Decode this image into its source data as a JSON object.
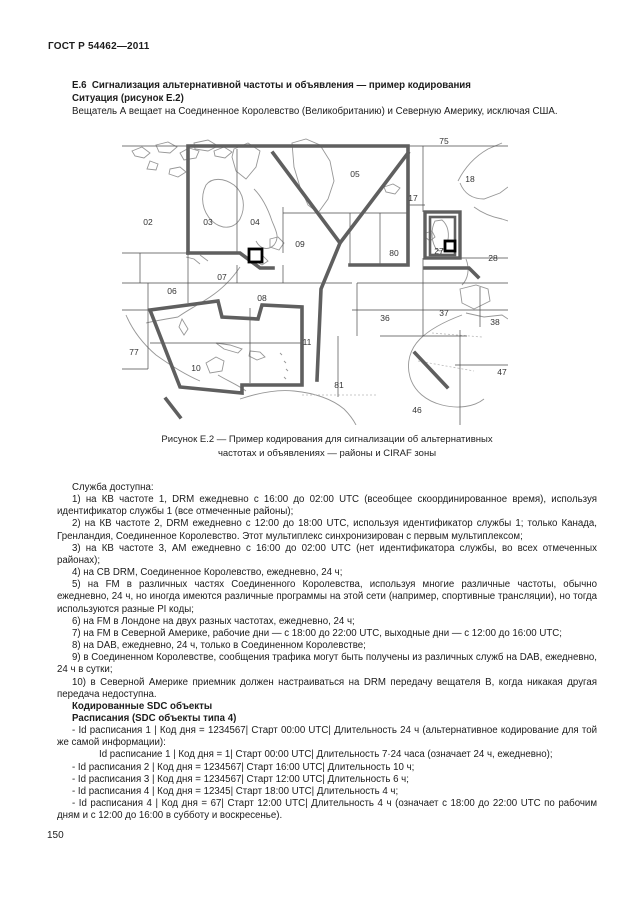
{
  "page": {
    "standard": "ГОСТ Р 54462—2011",
    "number": "150"
  },
  "section": {
    "heading": "Е.6  Сигнализация альтернативной частоты и объявления — пример кодирования",
    "situation": "Ситуация (рисунок Е.2)",
    "intro": "Вещатель А вещает на Соединенное Королевство (Великобританию) и Северную Америку, исключая США."
  },
  "figure": {
    "caption_line1": "Рисунок Е.2 — Пример кодирования для сигнализации об альтернативных",
    "caption_line2": "частотах и объявлениях — районы и CIRAF зоны",
    "zones": [
      {
        "label": "75",
        "x": 322,
        "y": 7
      },
      {
        "label": "05",
        "x": 233,
        "y": 40
      },
      {
        "label": "18",
        "x": 348,
        "y": 45
      },
      {
        "label": "17",
        "x": 291,
        "y": 64
      },
      {
        "label": "02",
        "x": 26,
        "y": 88
      },
      {
        "label": "03",
        "x": 86,
        "y": 88
      },
      {
        "label": "04",
        "x": 133,
        "y": 88
      },
      {
        "label": "09",
        "x": 178,
        "y": 110
      },
      {
        "label": "80",
        "x": 272,
        "y": 119
      },
      {
        "label": "27",
        "x": 317,
        "y": 117
      },
      {
        "label": "28",
        "x": 371,
        "y": 124
      },
      {
        "label": "07",
        "x": 100,
        "y": 143
      },
      {
        "label": "06",
        "x": 50,
        "y": 157
      },
      {
        "label": "08",
        "x": 140,
        "y": 164
      },
      {
        "label": "36",
        "x": 263,
        "y": 184
      },
      {
        "label": "37",
        "x": 322,
        "y": 179
      },
      {
        "label": "38",
        "x": 373,
        "y": 188
      },
      {
        "label": "77",
        "x": 12,
        "y": 218
      },
      {
        "label": "10",
        "x": 74,
        "y": 234
      },
      {
        "label": "11",
        "x": 185,
        "y": 208
      },
      {
        "label": "81",
        "x": 217,
        "y": 251
      },
      {
        "label": "47",
        "x": 380,
        "y": 238
      },
      {
        "label": "46",
        "x": 295,
        "y": 276
      }
    ],
    "markers": [
      {
        "x": 127,
        "y": 112,
        "size": 13
      },
      {
        "x": 323,
        "y": 104,
        "size": 10
      }
    ]
  },
  "body": {
    "paragraphs": [
      {
        "style": "normal",
        "text": "Служба доступна:"
      },
      {
        "style": "normal",
        "text": "1) на КВ частоте 1, DRM ежедневно с 16:00 до 02:00 UTC (всеобщее скоординированное время), используя идентификатор службы 1 (все отмеченные районы);"
      },
      {
        "style": "normal",
        "text": "2) на КВ частоте 2, DRM ежедневно с 12:00 до 18:00 UTC, используя идентификатор службы 1; только Канада, Гренландия, Соединенное Королевство. Этот мультиплекс синхронизирован с первым мультиплексом;"
      },
      {
        "style": "normal",
        "text": "3) на КВ частоте 3, АМ ежедневно с 16:00 до 02:00 UTC (нет идентификатора службы, во всех отмеченных районах);"
      },
      {
        "style": "normal",
        "text": "4) на СВ DRM, Соединенное Королевство, ежедневно, 24 ч;"
      },
      {
        "style": "normal",
        "text": "5) на FM в различных частях Соединенного Королевства, используя многие различные частоты, обычно ежедневно, 24 ч, но иногда имеются различные программы на этой сети (например, спортивные трансляции), но тогда используются разные PI коды;"
      },
      {
        "style": "normal",
        "text": "6) на FM в Лондоне на двух разных частотах, ежедневно, 24 ч;"
      },
      {
        "style": "normal",
        "text": "7) на FM в Северной Америке, рабочие дни — с 18:00 до 22:00 UTC, выходные дни — с 12:00 до 16:00 UTC;"
      },
      {
        "style": "normal",
        "text": "8) на DAB, ежедневно, 24 ч, только в Соединенном Королевстве;"
      },
      {
        "style": "normal",
        "text": "9) в Соединенном Королевстве, сообщения трафика могут быть получены из различных служб на DAB, ежедневно, 24 ч в сутки;"
      },
      {
        "style": "normal",
        "text": "10) в Северной Америке приемник должен настраиваться на DRM передачу вещателя В, когда никакая другая передача недоступна."
      },
      {
        "style": "bold",
        "text": "Кодированные SDC объекты"
      },
      {
        "style": "bold",
        "text": "Расписания (SDC объекты типа 4)"
      },
      {
        "style": "normal",
        "text": "- Id расписания 1 | Код дня = 1234567| Старт 00:00 UTC| Длительность 24 ч (альтернативное кодирование для той же самой информации):"
      },
      {
        "style": "indent2",
        "text": "Id расписание 1 | Код дня = 1| Старт 00:00 UTC| Длительность 7·24 часа (означает 24 ч, ежедневно);"
      },
      {
        "style": "normal",
        "text": "- Id расписания 2 | Код дня = 1234567| Старт 16:00 UTC| Длительность 10 ч;"
      },
      {
        "style": "normal",
        "text": "- Id расписания 3 | Код дня = 1234567| Старт 12:00 UTC| Длительность 6 ч;"
      },
      {
        "style": "normal",
        "text": "- Id расписания 4 | Код дня = 12345| Старт 18:00 UTC| Длительность 4 ч;"
      },
      {
        "style": "normal",
        "text": "- Id расписания 4 | Код дня = 67| Старт 12:00 UTC| Длительность 4 ч (означает с 18:00 до 22:00 UTC по рабочим дням и с 12:00 до 16:00 в субботу и воскресенье)."
      }
    ]
  }
}
